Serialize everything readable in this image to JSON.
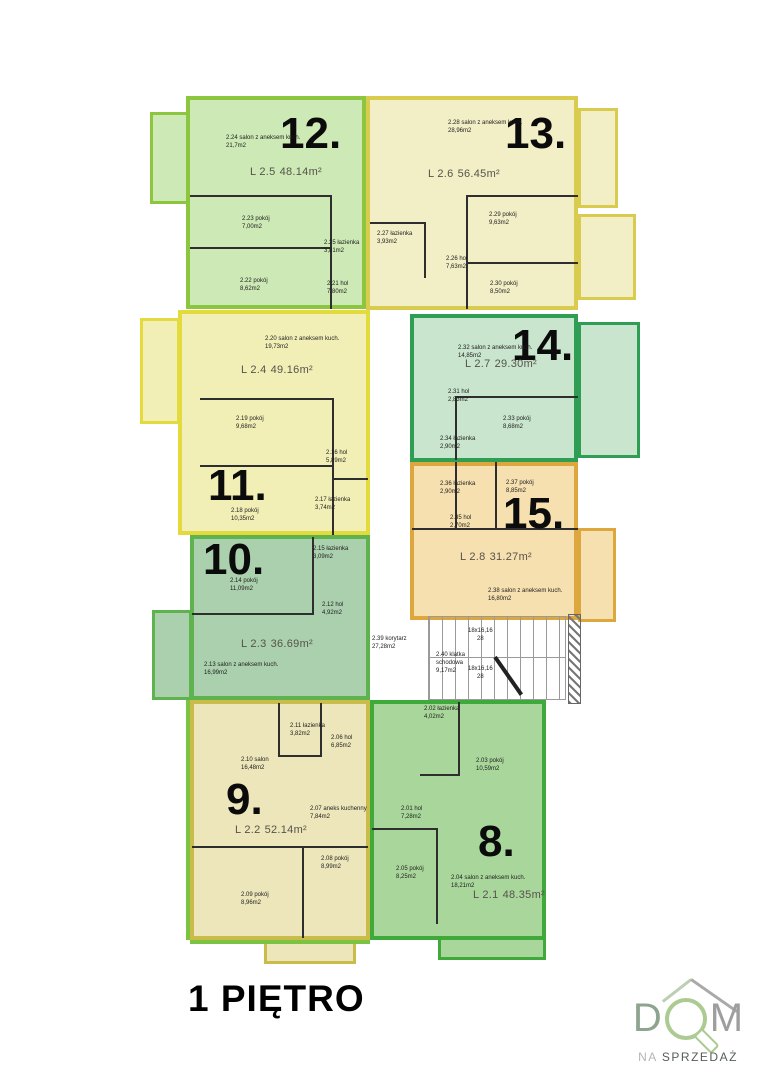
{
  "floor_title": "1 PIĘTRO",
  "logo": {
    "letter_d": "D",
    "letter_m": "M",
    "subtitle_na": "NA",
    "subtitle_rest": "SPRZEDAŻ"
  },
  "stairs": {
    "corridor": {
      "label": "2.39 korytarz",
      "area": "27,28m2"
    },
    "stairwell": {
      "label": "2.40 klatka schodowa",
      "area": "9,17m2"
    },
    "run_top": {
      "label": "18x16,16",
      "count": "28"
    },
    "run_bottom": {
      "label": "18x16,16",
      "count": "28"
    }
  },
  "apartments": [
    {
      "number": "12.",
      "unit": "L 2.5",
      "area": "48.14m²",
      "fill": "#cde9b5",
      "border": "#8cc63e",
      "rooms": [
        {
          "label": "2.24 salon z aneksem kuch.",
          "area": "21,7m2"
        },
        {
          "label": "2.23 pokój",
          "area": "7,00m2"
        },
        {
          "label": "2.25 łazienka",
          "area": "3,81m2"
        },
        {
          "label": "2.22 pokój",
          "area": "8,62m2"
        },
        {
          "label": "2.21 hol",
          "area": "7,80m2"
        }
      ]
    },
    {
      "number": "13.",
      "unit": "L 2.6",
      "area": "56.45m²",
      "fill": "#f2eec6",
      "border": "#d9cb4e",
      "rooms": [
        {
          "label": "2.28 salon z aneksem kuch.",
          "area": "28,96m2"
        },
        {
          "label": "2.27 łazienka",
          "area": "3,93m2"
        },
        {
          "label": "2.29 pokój",
          "area": "9,63m2"
        },
        {
          "label": "2.26 hol",
          "area": "7,63m2"
        },
        {
          "label": "2.30 pokój",
          "area": "8,50m2"
        }
      ]
    },
    {
      "number": "14.",
      "unit": "L 2.7",
      "area": "29.30m²",
      "fill": "#c9e5cd",
      "border": "#2f9e55",
      "rooms": [
        {
          "label": "2.32 salon z aneksem kuch.",
          "area": "14,85m2"
        },
        {
          "label": "2.31 hol",
          "area": "2,83m2"
        },
        {
          "label": "2.33 pokój",
          "area": "8,68m2"
        },
        {
          "label": "2.34 łazienka",
          "area": "2,90m2"
        }
      ]
    },
    {
      "number": "15.",
      "unit": "L 2.8",
      "area": "31.27m²",
      "fill": "#f7e0af",
      "border": "#dda73e",
      "rooms": [
        {
          "label": "2.36 łazienka",
          "area": "2,90m2"
        },
        {
          "label": "2.37 pokój",
          "area": "8,85m2"
        },
        {
          "label": "2.35 hol",
          "area": "2,70m2"
        },
        {
          "label": "2.38 salon z aneksem kuch.",
          "area": "16,80m2"
        }
      ]
    },
    {
      "number": "11.",
      "unit": "L 2.4",
      "area": "49.16m²",
      "fill": "#f2efb6",
      "border": "#e3da3e",
      "rooms": [
        {
          "label": "2.20 salon z aneksem kuch.",
          "area": "19,73m2"
        },
        {
          "label": "2.19 pokój",
          "area": "9,68m2"
        },
        {
          "label": "2.16 hol",
          "area": "5,89m2"
        },
        {
          "label": "2.17 łazienka",
          "area": "3,74m2"
        },
        {
          "label": "2.18 pokój",
          "area": "10,35m2"
        }
      ]
    },
    {
      "number": "10.",
      "unit": "L 2.3",
      "area": "36.69m²",
      "fill": "#abd0ad",
      "border": "#5fb34e",
      "rooms": [
        {
          "label": "2.15 łazienka",
          "area": "3,09m2"
        },
        {
          "label": "2.14 pokój",
          "area": "11,09m2"
        },
        {
          "label": "2.12 hol",
          "area": "4,92m2"
        },
        {
          "label": "2.13 salon z aneksem kuch.",
          "area": "16,99m2"
        }
      ]
    },
    {
      "number": "9.",
      "unit": "L 2.2",
      "area": "52.14m²",
      "fill": "#ede6ba",
      "border": "#c9bc4a",
      "rooms": [
        {
          "label": "2.11 łazienka",
          "area": "3,82m2"
        },
        {
          "label": "2.06 hol",
          "area": "6,85m2"
        },
        {
          "label": "2.10 salon",
          "area": "16,48m2"
        },
        {
          "label": "2.07 aneks kuchenny",
          "area": "7,84m2"
        },
        {
          "label": "2.08 pokój",
          "area": "8,99m2"
        },
        {
          "label": "2.09 pokój",
          "area": "8,96m2"
        }
      ]
    },
    {
      "number": "8.",
      "unit": "L 2.1",
      "area": "48.35m²",
      "fill": "#a9d79b",
      "border": "#3fa93a",
      "rooms": [
        {
          "label": "2.02 łazienka",
          "area": "4,02m2"
        },
        {
          "label": "2.03 pokój",
          "area": "10,59m2"
        },
        {
          "label": "2.01 hol",
          "area": "7,28m2"
        },
        {
          "label": "2.05 pokój",
          "area": "8,25m2"
        },
        {
          "label": "2.04 salon z aneksem kuch.",
          "area": "18,21m2"
        }
      ]
    }
  ]
}
